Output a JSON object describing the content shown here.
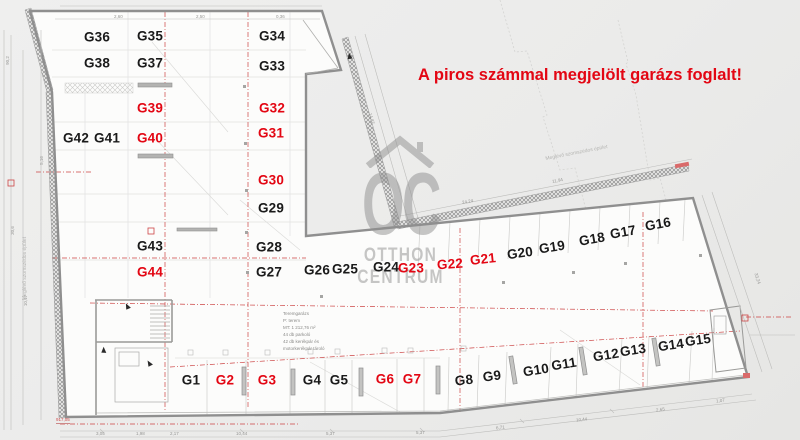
{
  "banner": {
    "text": "A piros számmal megjelölt garázs foglalt!"
  },
  "colors": {
    "occupied": "#e30613",
    "free": "#1a1a1a",
    "banner": "#e30613",
    "wall": "#8f8f8f",
    "red_dash": "#cc4444",
    "floor": "#fcfcfb"
  },
  "watermark": {
    "letters": "OC",
    "word1": "OTTHON",
    "word2": "CENTRUM",
    "icon": "house-roof-icon"
  },
  "neighbor_label_top": "Meglévő szomszédos épület",
  "neighbor_label_left": "Meglévő szomszédos épület",
  "info_block": {
    "lines": [
      "Teremgarázs",
      "P:        terem",
      "MT: 1 212,76 m²",
      "44 db parkoló",
      "42 db kerékpár és",
      "motorkerékpár tároló"
    ]
  },
  "red_note": "917,05",
  "garages": [
    {
      "id": "G36",
      "x": 97,
      "y": 37,
      "rot": 0,
      "occupied": false
    },
    {
      "id": "G35",
      "x": 150,
      "y": 36,
      "rot": 0,
      "occupied": false
    },
    {
      "id": "G34",
      "x": 272,
      "y": 36,
      "rot": 0,
      "occupied": false
    },
    {
      "id": "G38",
      "x": 97,
      "y": 63,
      "rot": 0,
      "occupied": false
    },
    {
      "id": "G37",
      "x": 150,
      "y": 63,
      "rot": 0,
      "occupied": false
    },
    {
      "id": "G33",
      "x": 272,
      "y": 66,
      "rot": 0,
      "occupied": false
    },
    {
      "id": "G39",
      "x": 150,
      "y": 108,
      "rot": 0,
      "occupied": true
    },
    {
      "id": "G32",
      "x": 272,
      "y": 108,
      "rot": 0,
      "occupied": true
    },
    {
      "id": "G42",
      "x": 76,
      "y": 138,
      "rot": 0,
      "occupied": false
    },
    {
      "id": "G41",
      "x": 107,
      "y": 138,
      "rot": 0,
      "occupied": false
    },
    {
      "id": "G40",
      "x": 150,
      "y": 138,
      "rot": 0,
      "occupied": true
    },
    {
      "id": "G31",
      "x": 271,
      "y": 133,
      "rot": 0,
      "occupied": true
    },
    {
      "id": "G30",
      "x": 271,
      "y": 180,
      "rot": 0,
      "occupied": true
    },
    {
      "id": "G29",
      "x": 271,
      "y": 208,
      "rot": 0,
      "occupied": false
    },
    {
      "id": "G43",
      "x": 150,
      "y": 246,
      "rot": 0,
      "occupied": false
    },
    {
      "id": "G28",
      "x": 269,
      "y": 247,
      "rot": 0,
      "occupied": false
    },
    {
      "id": "G44",
      "x": 150,
      "y": 272,
      "rot": 0,
      "occupied": true
    },
    {
      "id": "G27",
      "x": 269,
      "y": 272,
      "rot": 0,
      "occupied": false
    },
    {
      "id": "G26",
      "x": 317,
      "y": 270,
      "rot": 0,
      "occupied": false
    },
    {
      "id": "G25",
      "x": 345,
      "y": 269,
      "rot": 0,
      "occupied": false
    },
    {
      "id": "G24",
      "x": 386,
      "y": 267,
      "rot": 0,
      "occupied": false
    },
    {
      "id": "G23",
      "x": 411,
      "y": 268,
      "rot": 0,
      "occupied": true
    },
    {
      "id": "G22",
      "x": 450,
      "y": 264,
      "rot": -4,
      "occupied": true
    },
    {
      "id": "G21",
      "x": 483,
      "y": 259,
      "rot": -6,
      "occupied": true
    },
    {
      "id": "G20",
      "x": 520,
      "y": 253,
      "rot": -8,
      "occupied": false
    },
    {
      "id": "G19",
      "x": 552,
      "y": 247,
      "rot": -9,
      "occupied": false
    },
    {
      "id": "G18",
      "x": 592,
      "y": 239,
      "rot": -10,
      "occupied": false
    },
    {
      "id": "G17",
      "x": 623,
      "y": 232,
      "rot": -10,
      "occupied": false
    },
    {
      "id": "G16",
      "x": 658,
      "y": 224,
      "rot": -10,
      "occupied": false
    },
    {
      "id": "G1",
      "x": 191,
      "y": 380,
      "rot": 0,
      "occupied": false
    },
    {
      "id": "G2",
      "x": 225,
      "y": 380,
      "rot": 0,
      "occupied": true
    },
    {
      "id": "G3",
      "x": 267,
      "y": 380,
      "rot": 0,
      "occupied": true
    },
    {
      "id": "G4",
      "x": 312,
      "y": 380,
      "rot": 0,
      "occupied": false
    },
    {
      "id": "G5",
      "x": 339,
      "y": 380,
      "rot": 0,
      "occupied": false
    },
    {
      "id": "G6",
      "x": 385,
      "y": 379,
      "rot": 0,
      "occupied": true
    },
    {
      "id": "G7",
      "x": 412,
      "y": 379,
      "rot": 0,
      "occupied": true
    },
    {
      "id": "G8",
      "x": 464,
      "y": 380,
      "rot": -6,
      "occupied": false
    },
    {
      "id": "G9",
      "x": 492,
      "y": 376,
      "rot": -7,
      "occupied": false
    },
    {
      "id": "G10",
      "x": 536,
      "y": 370,
      "rot": -9,
      "occupied": false
    },
    {
      "id": "G11",
      "x": 564,
      "y": 364,
      "rot": -9,
      "occupied": false
    },
    {
      "id": "G12",
      "x": 606,
      "y": 355,
      "rot": -9,
      "occupied": false
    },
    {
      "id": "G13",
      "x": 633,
      "y": 350,
      "rot": -9,
      "occupied": false
    },
    {
      "id": "G14",
      "x": 671,
      "y": 345,
      "rot": -8,
      "occupied": false
    },
    {
      "id": "G15",
      "x": 698,
      "y": 340,
      "rot": -8,
      "occupied": false
    }
  ],
  "dimensions": [
    {
      "t": "3,05",
      "x": 96,
      "y": 431,
      "rot": 0
    },
    {
      "t": "1,98",
      "x": 136,
      "y": 431,
      "rot": 0
    },
    {
      "t": "2,17",
      "x": 170,
      "y": 431,
      "rot": 0
    },
    {
      "t": "10,44",
      "x": 236,
      "y": 431,
      "rot": 0
    },
    {
      "t": "5,37",
      "x": 326,
      "y": 431,
      "rot": 0
    },
    {
      "t": "5,37",
      "x": 416,
      "y": 430,
      "rot": 0
    },
    {
      "t": "6,71",
      "x": 496,
      "y": 425,
      "rot": -6
    },
    {
      "t": "10,44",
      "x": 576,
      "y": 417,
      "rot": -7
    },
    {
      "t": "2,65",
      "x": 656,
      "y": 407,
      "rot": -8
    },
    {
      "t": "1,07",
      "x": 716,
      "y": 398,
      "rot": -8
    },
    {
      "t": "30,6",
      "x": 8,
      "y": 228,
      "rot": -90
    },
    {
      "t": "10,17",
      "x": 20,
      "y": 298,
      "rot": -90
    },
    {
      "t": "5,16",
      "x": 37,
      "y": 158,
      "rot": -90
    },
    {
      "t": "90,2",
      "x": 3,
      "y": 58,
      "rot": -90
    },
    {
      "t": "2,60",
      "x": 114,
      "y": 14,
      "rot": 0
    },
    {
      "t": "2,50",
      "x": 196,
      "y": 14,
      "rot": 0
    },
    {
      "t": "0,36",
      "x": 276,
      "y": 14,
      "rot": 0
    },
    {
      "t": "11,94",
      "x": 552,
      "y": 178,
      "rot": -11
    },
    {
      "t": "24,24",
      "x": 462,
      "y": 199,
      "rot": -11
    },
    {
      "t": "33,24",
      "x": 752,
      "y": 276,
      "rot": 73
    },
    {
      "t": "14,87",
      "x": 366,
      "y": 116,
      "rot": 74
    }
  ]
}
